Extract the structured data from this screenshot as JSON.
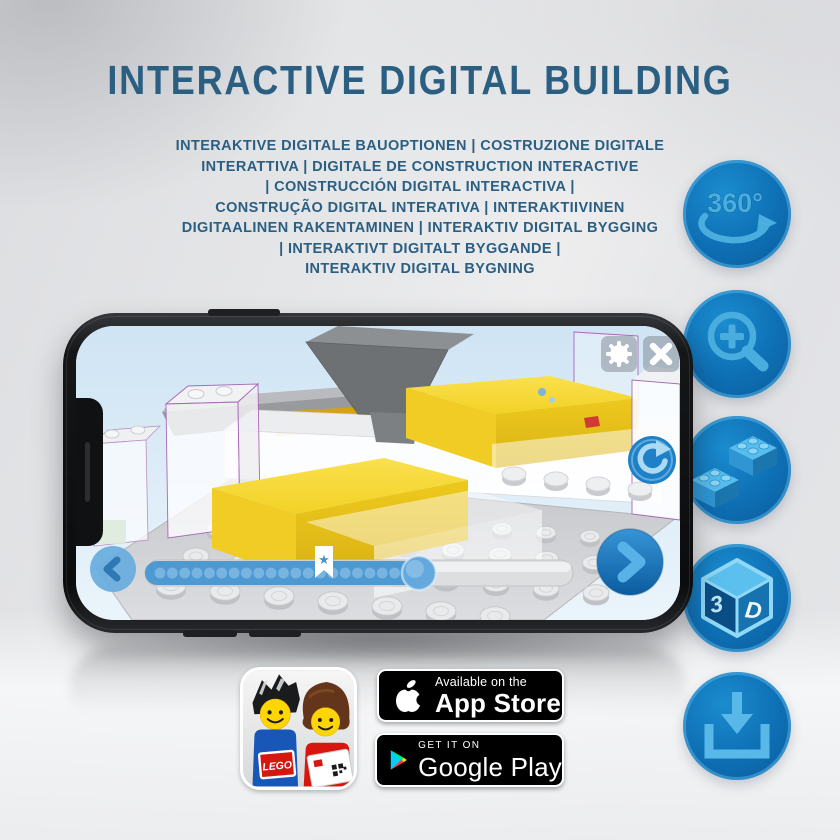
{
  "title": "INTERACTIVE DIGITAL BUILDING",
  "subtitle": {
    "lines": [
      "INTERAKTIVE DIGITALE BAUOPTIONEN | COSTRUZIONE DIGITALE",
      "INTERATTIVA | DIGITALE DE CONSTRUCTION INTERACTIVE",
      "| CONSTRUCCIÓN DIGITAL INTERACTIVA |",
      "CONSTRUÇÃO DIGITAL INTERATIVA | INTERAKTIIVINEN",
      "DIGITAALINEN RAKENTAMINEN | INTERAKTIV DIGITAL BYGGING",
      "| INTERAKTIVT DIGITALT BYGGANDE |",
      "INTERAKTIV DIGITAL BYGNING"
    ]
  },
  "feature_rail": {
    "items": [
      {
        "icon": "rotate-360-icon",
        "label": "360°"
      },
      {
        "icon": "zoom-in-icon"
      },
      {
        "icon": "lego-bricks-icon"
      },
      {
        "icon": "cube-3d-icon",
        "label_left": "3",
        "label_right": "D"
      },
      {
        "icon": "download-icon"
      }
    ]
  },
  "phone": {
    "screen": "lego-3d-builder-view",
    "builder": {
      "progress_percent": 64,
      "step_dots": 21,
      "bookmark_percent": 42
    }
  },
  "badges": {
    "lego_app": {
      "logo_text": "LEGO"
    },
    "app_store": {
      "tagline": "Available on the",
      "name": "App Store"
    },
    "google_play": {
      "tagline": "GET IT ON",
      "name": "Google Play"
    }
  },
  "colors": {
    "title_blue": "#2b5f82",
    "circle_blue": "#0e6fb4",
    "icon_light_blue": "#49aede",
    "brick_yellow": "#f2cf1f",
    "badge_black": "#000000",
    "screen_sky": "#d8e9f6"
  }
}
